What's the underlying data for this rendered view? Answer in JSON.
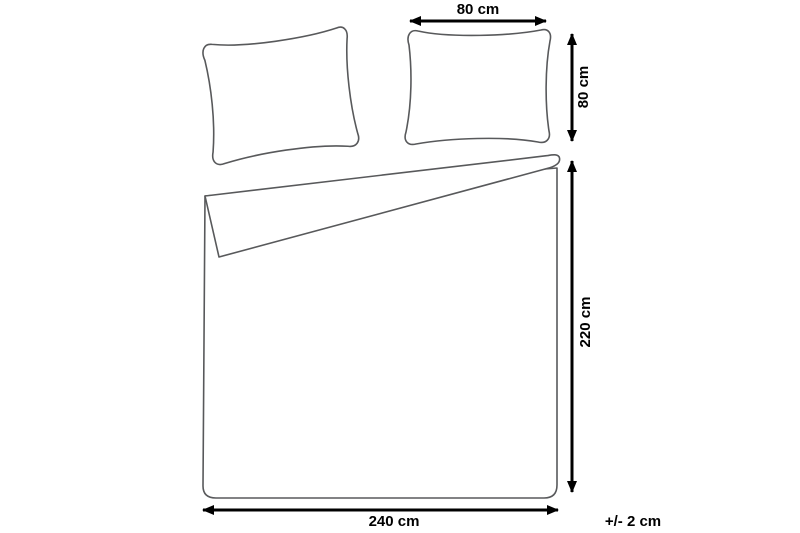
{
  "diagram": {
    "type": "product-dimensions",
    "subject": "bedding-set-duvet-cover-and-pillowcases",
    "labels": {
      "pillow_width": "80 cm",
      "pillow_height": "80 cm",
      "duvet_height": "220 cm",
      "duvet_width": "240 cm",
      "tolerance": "+/- 2 cm"
    },
    "measurements": [
      {
        "part": "pillowcase",
        "dimension": "width",
        "value_cm": 80
      },
      {
        "part": "pillowcase",
        "dimension": "height",
        "value_cm": 80
      },
      {
        "part": "duvet-cover",
        "dimension": "height",
        "value_cm": 220
      },
      {
        "part": "duvet-cover",
        "dimension": "width",
        "value_cm": 240
      },
      {
        "part": "all",
        "dimension": "tolerance",
        "value_cm": 2
      }
    ],
    "illustrations": {
      "left_pillow": "tilted-pillow-outline",
      "right_pillow": "pillow-outline",
      "duvet": "duvet-cover-with-folded-corner"
    }
  },
  "colors": {
    "background": "#ffffff",
    "outline": "#58595b",
    "dimension": "#000000",
    "label_text": "#000000"
  }
}
